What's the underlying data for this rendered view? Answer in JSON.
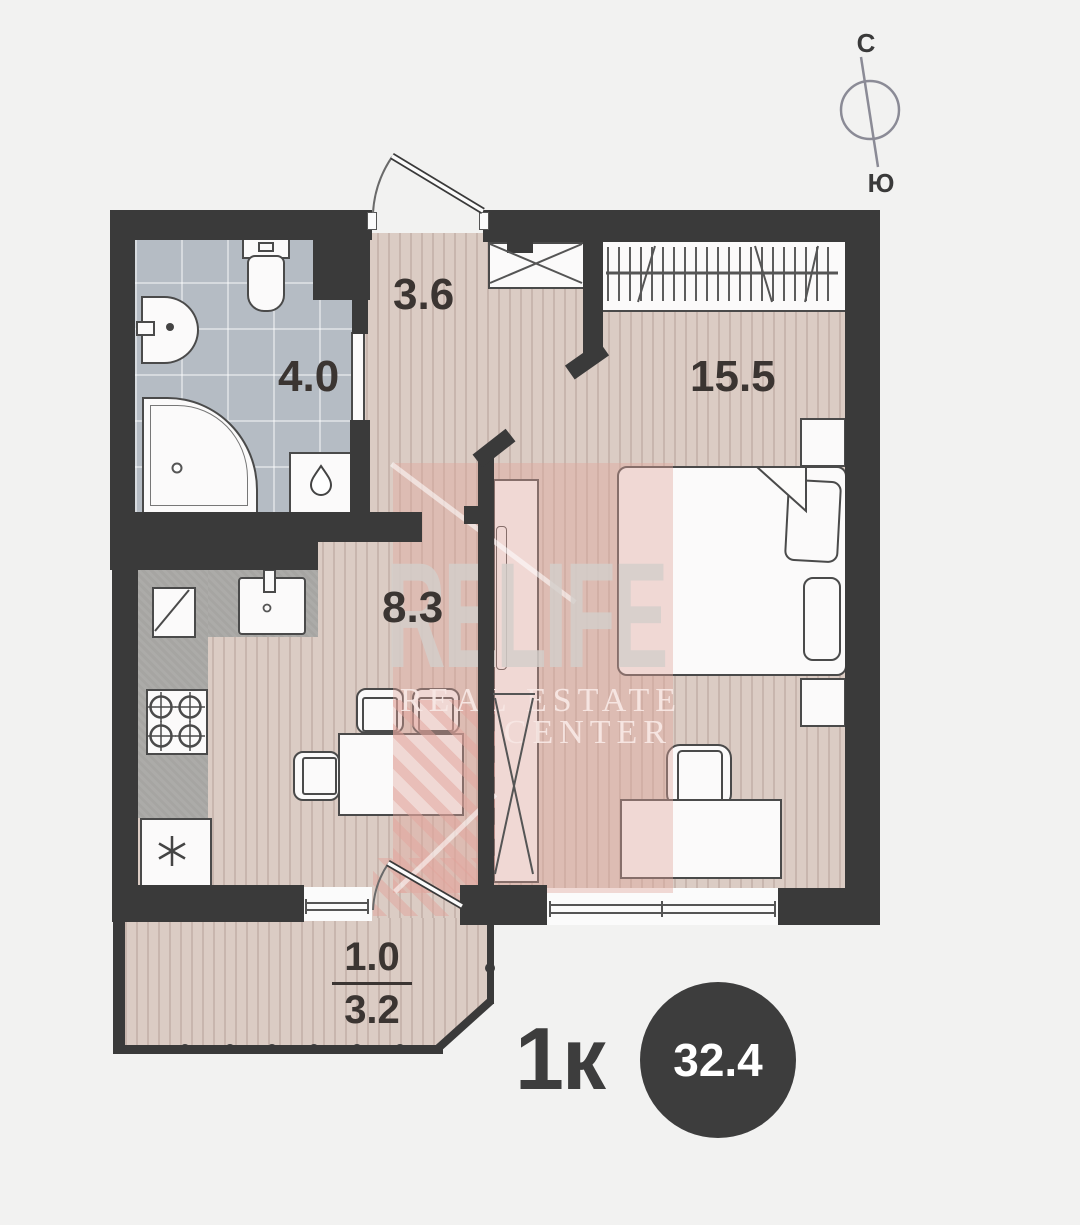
{
  "compass": {
    "north": "С",
    "south": "Ю"
  },
  "rooms": {
    "hallway": {
      "name": "hallway",
      "area": "3.6"
    },
    "bathroom": {
      "name": "bathroom",
      "area": "4.0"
    },
    "bedroom": {
      "name": "bedroom",
      "area": "15.5"
    },
    "kitchen": {
      "name": "kitchen-living",
      "area": "8.3"
    },
    "balcony": {
      "name": "balcony",
      "area_coefficient": "1.0",
      "area_full": "3.2"
    }
  },
  "summary": {
    "apartment_type": "1к",
    "total_area": "32.4"
  },
  "watermark": {
    "brand": "RELIFE",
    "line1": "REAL ESTATE",
    "line2": "CENTER"
  },
  "colors": {
    "background": "#f2f2f1",
    "wall": "#3a3a3a",
    "wood_floor": "#dbccc4",
    "tile_floor": "#b5bcc4",
    "counter": "#a6a5a2",
    "watermark_pink": "#e2a49c",
    "badge": "#3d3d3d",
    "label_text": "#3b3532"
  }
}
